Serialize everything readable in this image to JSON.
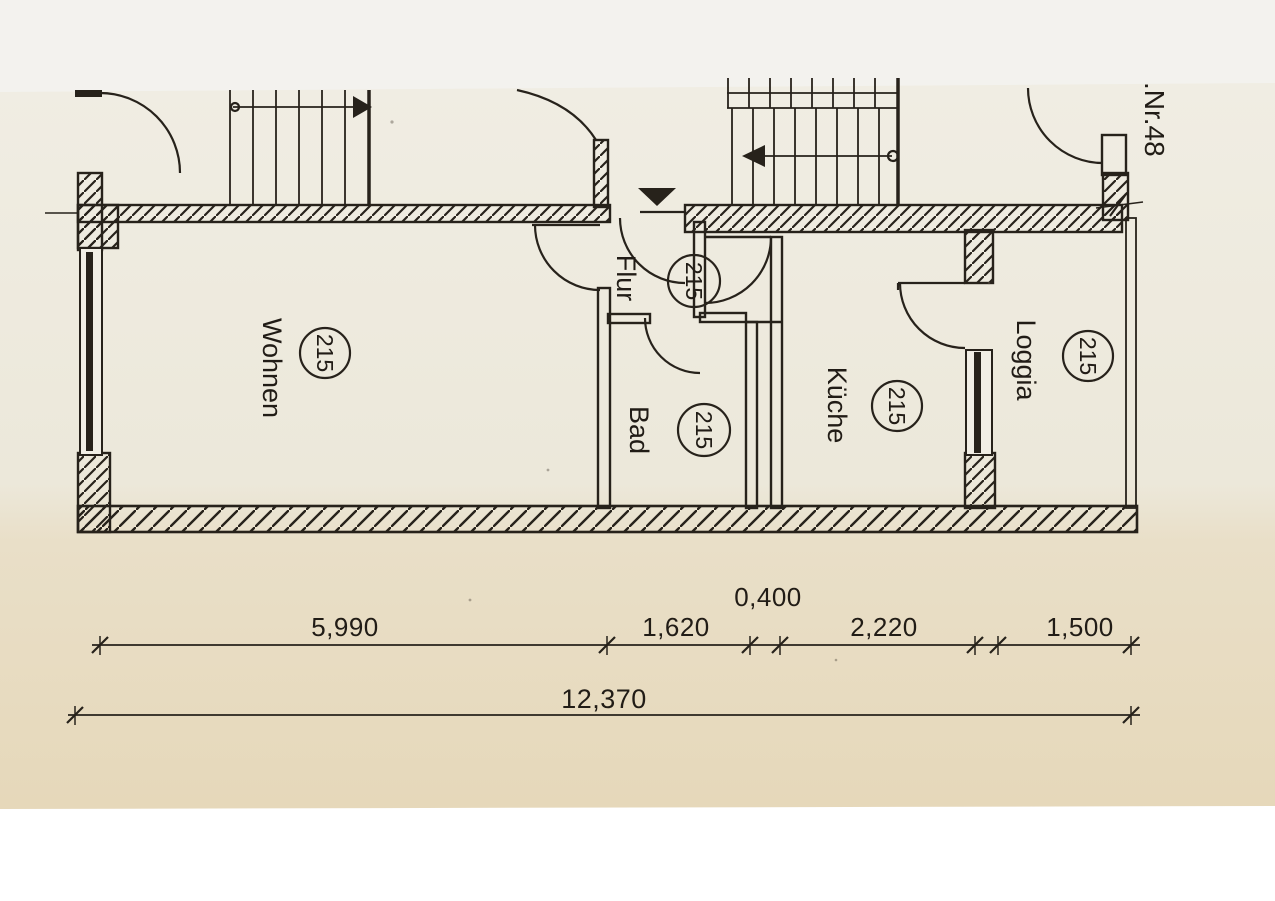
{
  "document": {
    "kind": "scanned architectural floor plan",
    "apartment_ref": ".Nr.48",
    "ink_color": "#27221b",
    "paper_top_color": "#f0ede3",
    "paper_bottom_color": "#e6d8ba",
    "margin_top_color": "#f3f2ee",
    "margin_bottom_color": "#ffffff"
  },
  "rooms": [
    {
      "id": "wohnen",
      "label": "Wohnen",
      "number": "215"
    },
    {
      "id": "flur",
      "label": "Flur",
      "number": "215"
    },
    {
      "id": "bad",
      "label": "Bad",
      "number": "215"
    },
    {
      "id": "kueche",
      "label": "Küche",
      "number": "215"
    },
    {
      "id": "loggia",
      "label": "Loggia",
      "number": "215"
    }
  ],
  "dimensions": {
    "upper_segments": [
      {
        "value": "5,990"
      },
      {
        "value": "1,620"
      },
      {
        "value": "0,400"
      },
      {
        "value": "2,220"
      },
      {
        "value": "1,500"
      }
    ],
    "total": {
      "value": "12,370"
    }
  },
  "symbols": {
    "entrance_marker": "filled-triangle-entrance-icon",
    "stair_arrow_left_flight": "arrow-right-icon",
    "stair_arrow_upper_flight": "arrow-left-icon"
  }
}
